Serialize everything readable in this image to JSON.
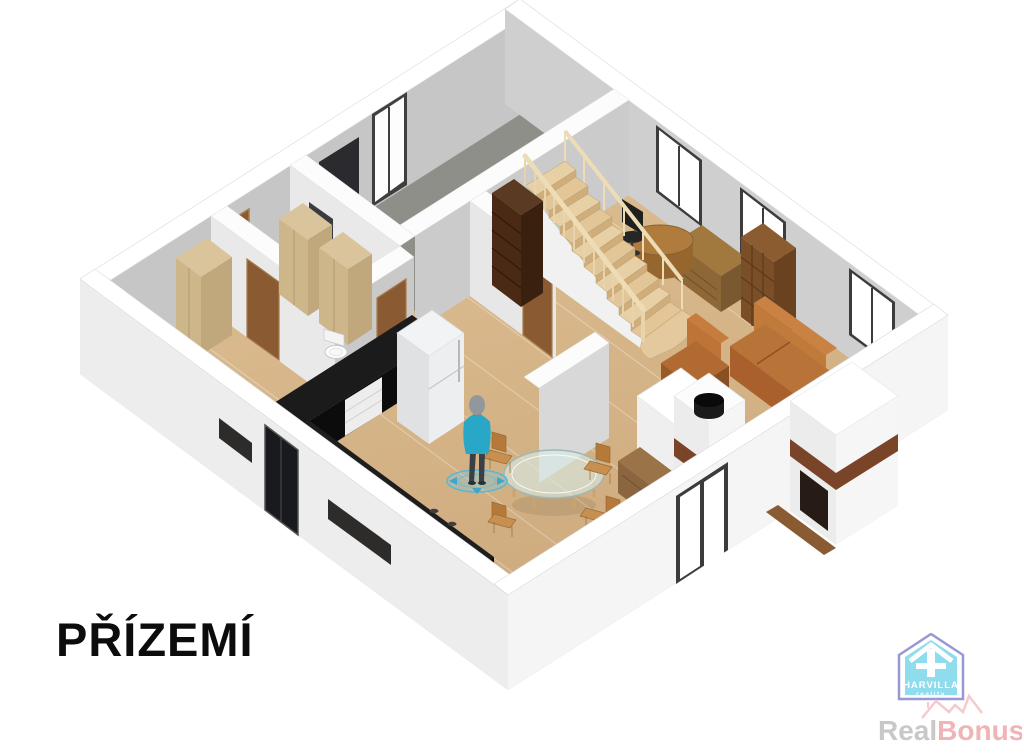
{
  "floor_label": "PŘÍZEMÍ",
  "branding": {
    "logo_name": "HARVILLA",
    "logo_subtitle": "reality",
    "watermark_primary": "Real",
    "watermark_secondary": "Bonus",
    "watermark_tld": ".cz"
  },
  "palette": {
    "background": "#ffffff",
    "wall_top": "#ffffff",
    "wall_interior_shade": "#c9c9c9",
    "wall_exterior": "#f2f2f2",
    "floor_wood": "#d8bb8d",
    "floor_concrete": "#8f8f8a",
    "kitchen_counter": "#151515",
    "stair_wood": "#e6cda4",
    "door_wood": "#8a5a33",
    "sofa_leather": "#b06a32",
    "figure_shirt": "#2aa9c4",
    "logo_house_fill": "#8edcec",
    "logo_outline": "#9898d2",
    "watermark_gray": "#c8c8c8",
    "watermark_pink": "#f0b3b6"
  }
}
